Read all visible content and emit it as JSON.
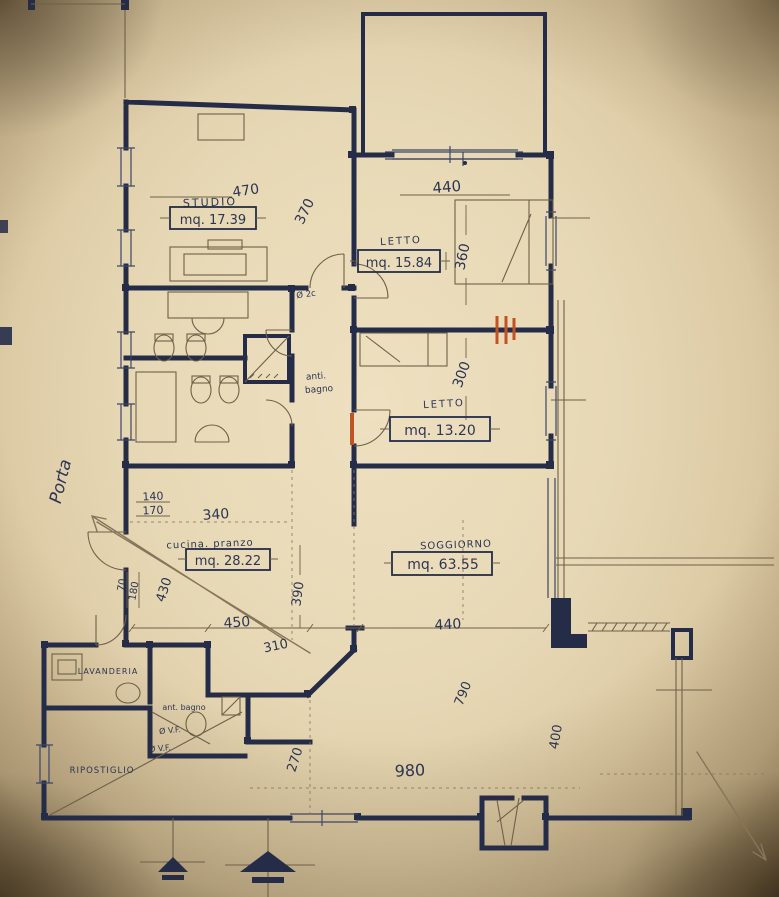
{
  "document": {
    "type": "floor-plan-photo",
    "language": "it"
  },
  "colors": {
    "paper": "#e7d8b6",
    "ink": "#242c48",
    "thin_line": "#6e6148",
    "accent_orange": "#c05325",
    "pencil": "#86755a"
  },
  "rooms": {
    "studio": {
      "label": "STUDIO",
      "area": "mq. 17.39"
    },
    "letto1": {
      "label": "LETTO",
      "area": "mq. 15.84"
    },
    "letto2": {
      "label": "LETTO",
      "area": "mq. 13.20"
    },
    "cucina": {
      "label": "cucina. pranzo",
      "area": "mq. 28.22"
    },
    "soggiorno": {
      "label": "SOGGIORNO",
      "area": "mq. 63.55"
    },
    "antibagno": {
      "line1": "anti.",
      "line2": "bagno"
    },
    "lavanderia": {
      "label": "LAVANDERIA"
    },
    "ant_bagno": {
      "label": "ant. bagno"
    },
    "ripostiglio": {
      "label": "RIPOSTIGLIO"
    }
  },
  "dimensions": {
    "studio_width": "470",
    "studio_depth": "370",
    "letto1_width": "440",
    "letto1_depth": "360",
    "letto2_depth": "300",
    "hall_140": "140",
    "hall_170": "170",
    "cucina_340": "340",
    "entry_70": "70",
    "entry_180": "180",
    "cucina_430": "430",
    "cucina_450": "450",
    "cucina_310": "310",
    "cucina_390": "390",
    "soggiorno_440": "440",
    "soggiorno_270": "270",
    "soggiorno_980": "980",
    "soggiorno_790": "790",
    "terrace_400": "400"
  },
  "annotations": {
    "porta": "Porta",
    "vf_1": "Ø V.F.",
    "vf_2": "Ø V.F.",
    "door_mark": "Ø 2c"
  }
}
